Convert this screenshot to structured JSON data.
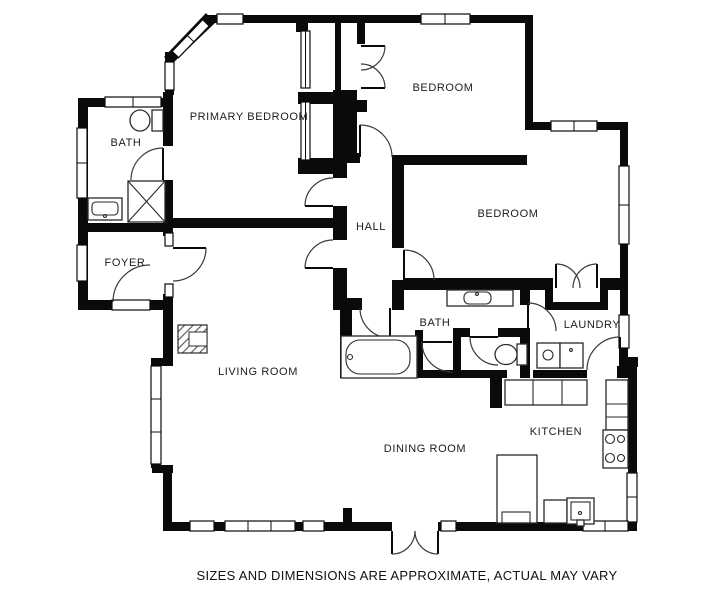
{
  "plan": {
    "rooms": [
      {
        "id": "primary-bedroom",
        "label": "PRIMARY BEDROOM"
      },
      {
        "id": "bedroom-top",
        "label": "BEDROOM"
      },
      {
        "id": "bath-primary",
        "label": "BATH"
      },
      {
        "id": "foyer",
        "label": "FOYER"
      },
      {
        "id": "hall",
        "label": "HALL"
      },
      {
        "id": "bedroom-right",
        "label": "BEDROOM"
      },
      {
        "id": "bath-hall",
        "label": "BATH"
      },
      {
        "id": "laundry",
        "label": "LAUNDRY"
      },
      {
        "id": "living-room",
        "label": "LIVING ROOM"
      },
      {
        "id": "dining-room",
        "label": "DINING ROOM"
      },
      {
        "id": "kitchen",
        "label": "KITCHEN"
      }
    ],
    "disclaimer": "SIZES AND DIMENSIONS ARE APPROXIMATE, ACTUAL MAY VARY",
    "colors": {
      "wall": "#0a0a0a",
      "background": "#ffffff",
      "label": "#1c1c1c"
    }
  }
}
